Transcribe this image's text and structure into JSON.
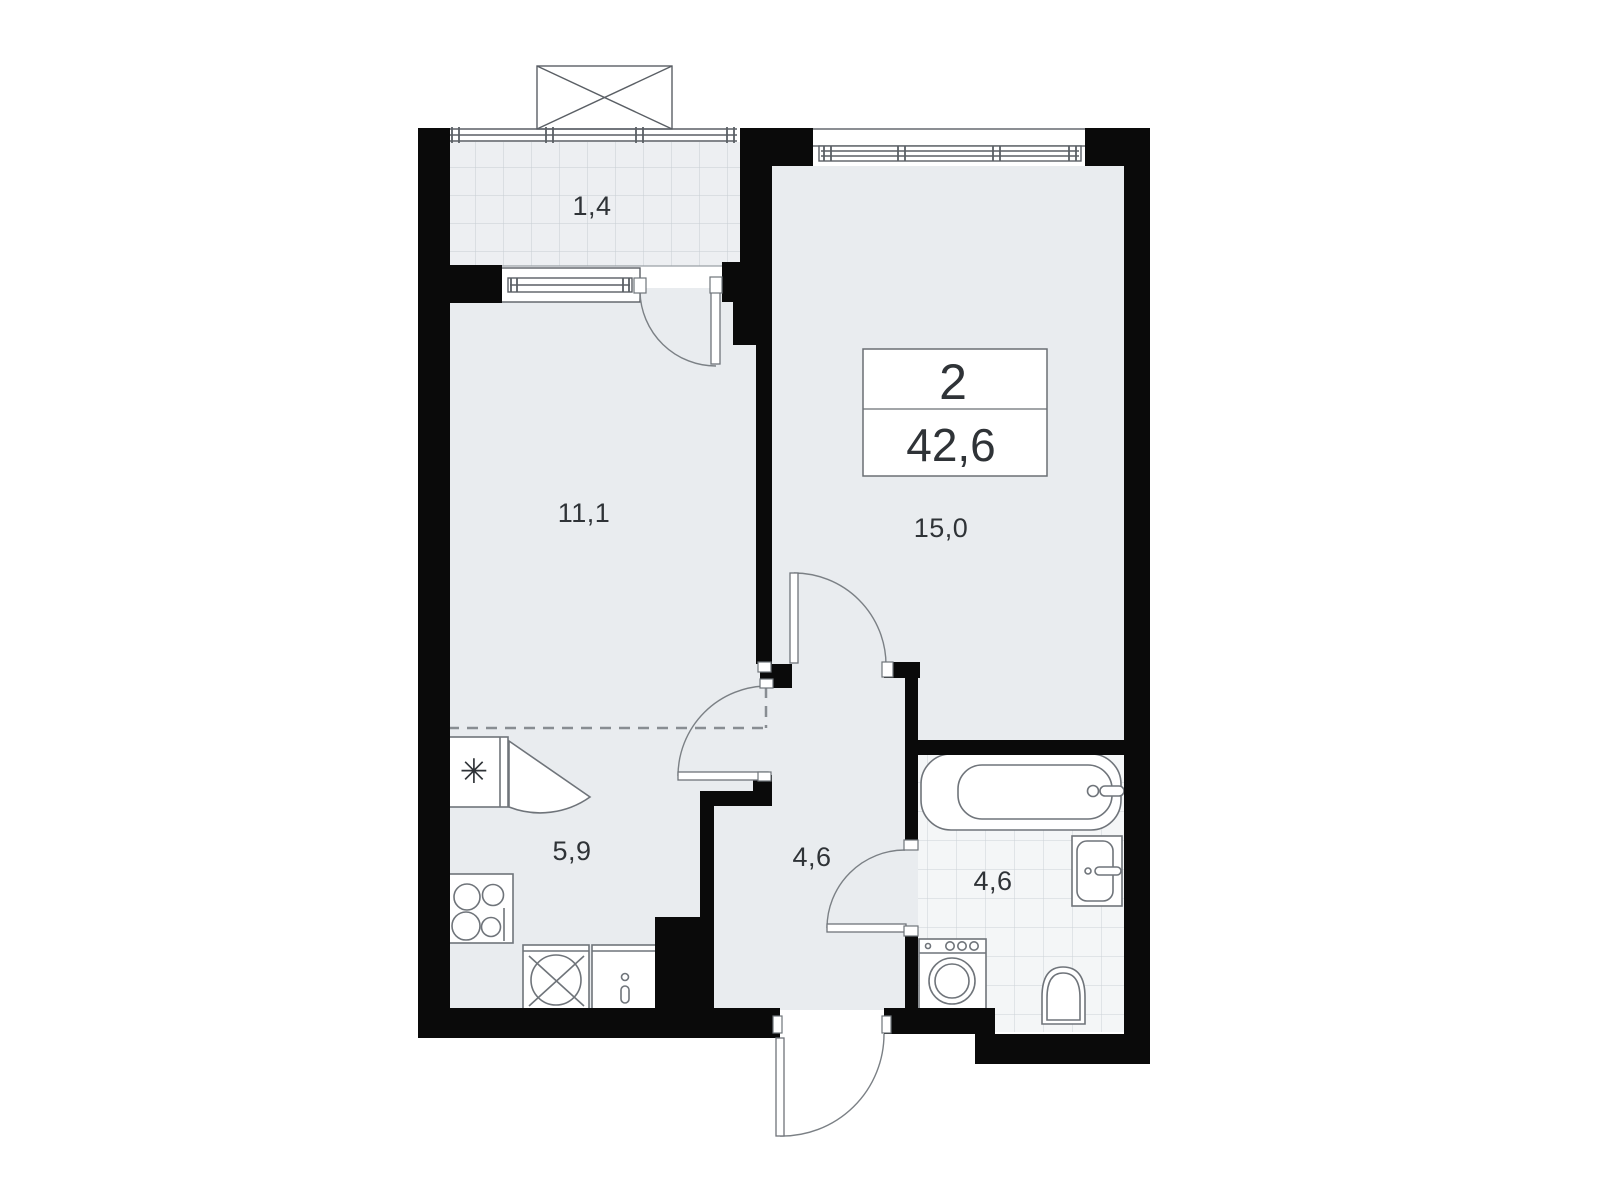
{
  "plan": {
    "type": "apartment-floor-plan",
    "info_box": {
      "rooms_count": "2",
      "total_area_m2": "42,6"
    },
    "rooms": [
      {
        "name": "balcony",
        "area": "1,4"
      },
      {
        "name": "living-room",
        "area": "11,1"
      },
      {
        "name": "bedroom",
        "area": "15,0"
      },
      {
        "name": "kitchen",
        "area": "5,9"
      },
      {
        "name": "hallway",
        "area": "4,6"
      },
      {
        "name": "bathroom",
        "area": "4,6"
      }
    ],
    "colors": {
      "wall": "#0a0a0a",
      "room_fill": "#e9ecef",
      "balcony_fill": "#edeff2",
      "tile_fill": "#f4f6f7",
      "grid_line": "#c7cdd3",
      "fixture_stroke": "#6f747a",
      "door_arc": "#7b8085",
      "text": "#2f3337"
    }
  }
}
